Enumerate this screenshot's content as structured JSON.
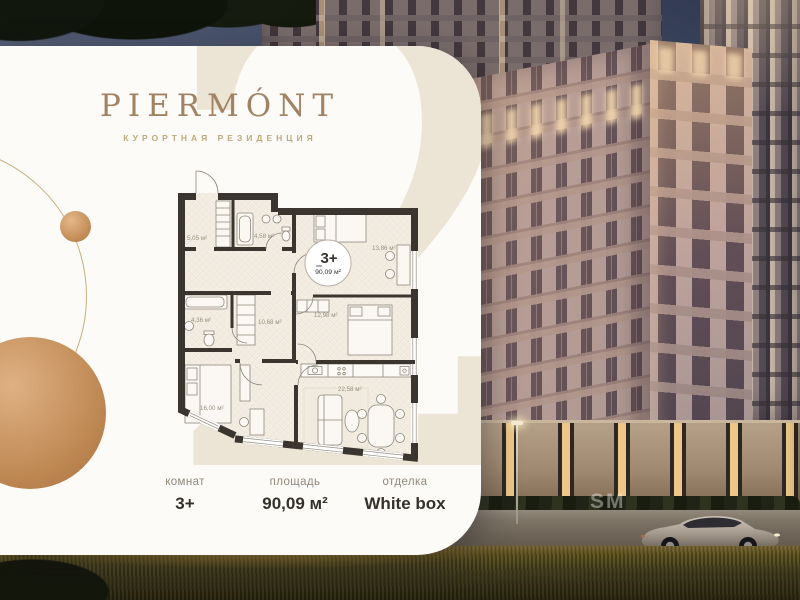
{
  "brand": {
    "logo": "PIERMÓNT",
    "tagline": "КУРОРТНАЯ РЕЗИДЕНЦИЯ"
  },
  "badge": {
    "rooms": "3+",
    "area": "90,09 м²"
  },
  "watermark": {
    "card_numeral": "2",
    "photo_text": "SM"
  },
  "plan": {
    "rooms": [
      {
        "name": "hall",
        "area": "5,05 м²"
      },
      {
        "name": "bathroom-1",
        "area": "4,58 м²"
      },
      {
        "name": "bedroom-1",
        "area": "13,86 м²"
      },
      {
        "name": "bedroom-2",
        "area": "12,98 м²"
      },
      {
        "name": "bathroom-2",
        "area": "4,36 м²"
      },
      {
        "name": "corridor",
        "area": "10,68 м²"
      },
      {
        "name": "bedroom-3",
        "area": "16,00 м²"
      },
      {
        "name": "kitchen-living",
        "area": "22,58 м²"
      }
    ]
  },
  "specs": [
    {
      "label": "комнат",
      "value": "3+"
    },
    {
      "label": "площадь",
      "value": "90,09 м²"
    },
    {
      "label": "отделка",
      "value": "White box"
    }
  ],
  "colors": {
    "accent_gold": "#c49a6c",
    "card_bg": "#fcfbf8",
    "wall_dark": "#3a362f",
    "beige_watermark": "#ece4d4"
  }
}
